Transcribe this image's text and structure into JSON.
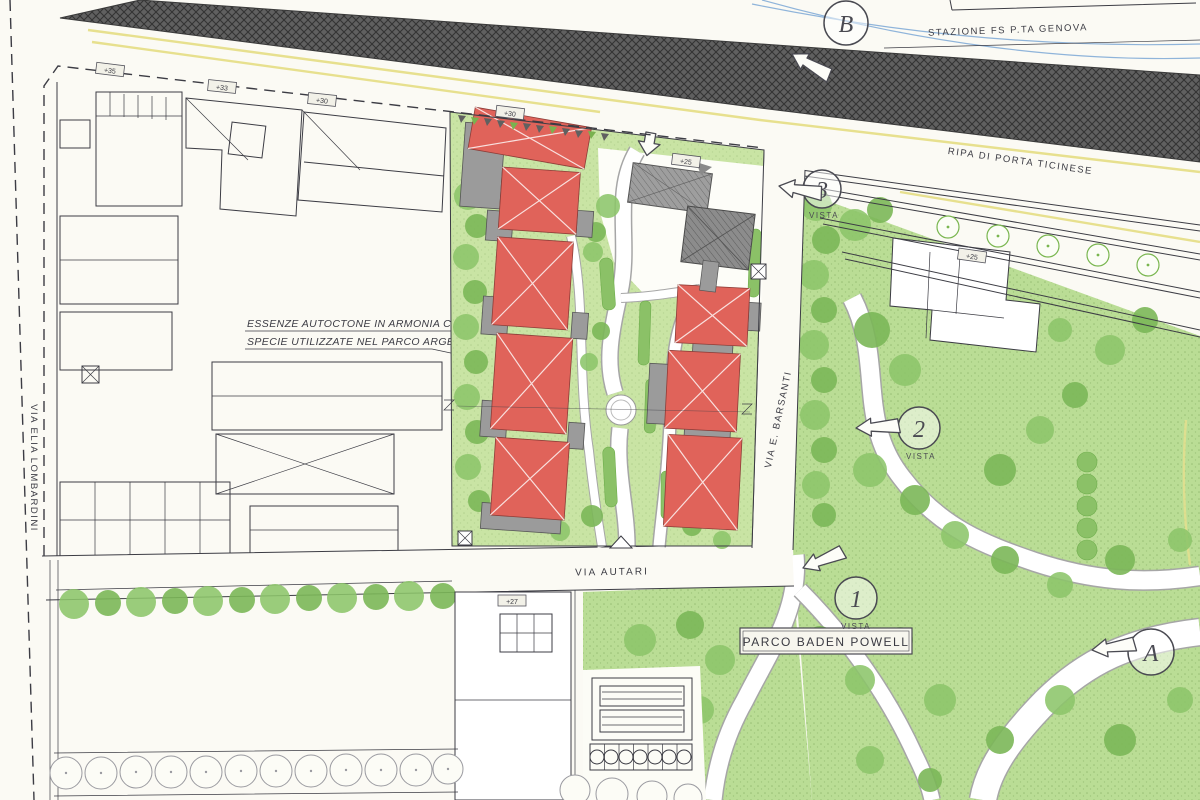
{
  "colors": {
    "paper": "#fbfaf4",
    "ink": "#3c3c44",
    "lawn": "#c9e4a4",
    "park": "#badd95",
    "tree": "#8cc56a",
    "treeD": "#7bb758",
    "red": "#e0635a",
    "gray": "#9b9b9b",
    "rail": "#5d5d5d",
    "yellow": "#e7e08e",
    "blue": "#8fb4da",
    "hedge": "#8bc167"
  },
  "labels": {
    "station": "STAZIONE FS P.TA GENOVA",
    "ripa": "RIPA DI PORTA TICINESE",
    "lombardini": "VIA ELIA LOMBARDINI",
    "autari": "VIA AUTARI",
    "barsanti": "VIA E. BARSANTI",
    "parco": "PARCO BADEN POWELL"
  },
  "annotation": {
    "line1": "ESSENZE AUTOCTONE IN ARMONIA CON LE",
    "line2": "SPECIE UTILIZZATE NEL PARCO ARGELATI"
  },
  "view_markers": {
    "b": {
      "label": "B"
    },
    "v3": {
      "label": "3",
      "caption": "VISTA"
    },
    "v2": {
      "label": "2",
      "caption": "VISTA"
    },
    "v1": {
      "label": "1",
      "caption": "VISTA"
    },
    "a": {
      "label": "A"
    }
  },
  "elevation_markers": [
    "+35",
    "+33",
    "+30",
    "+30",
    "+25",
    "+25",
    "+27"
  ]
}
